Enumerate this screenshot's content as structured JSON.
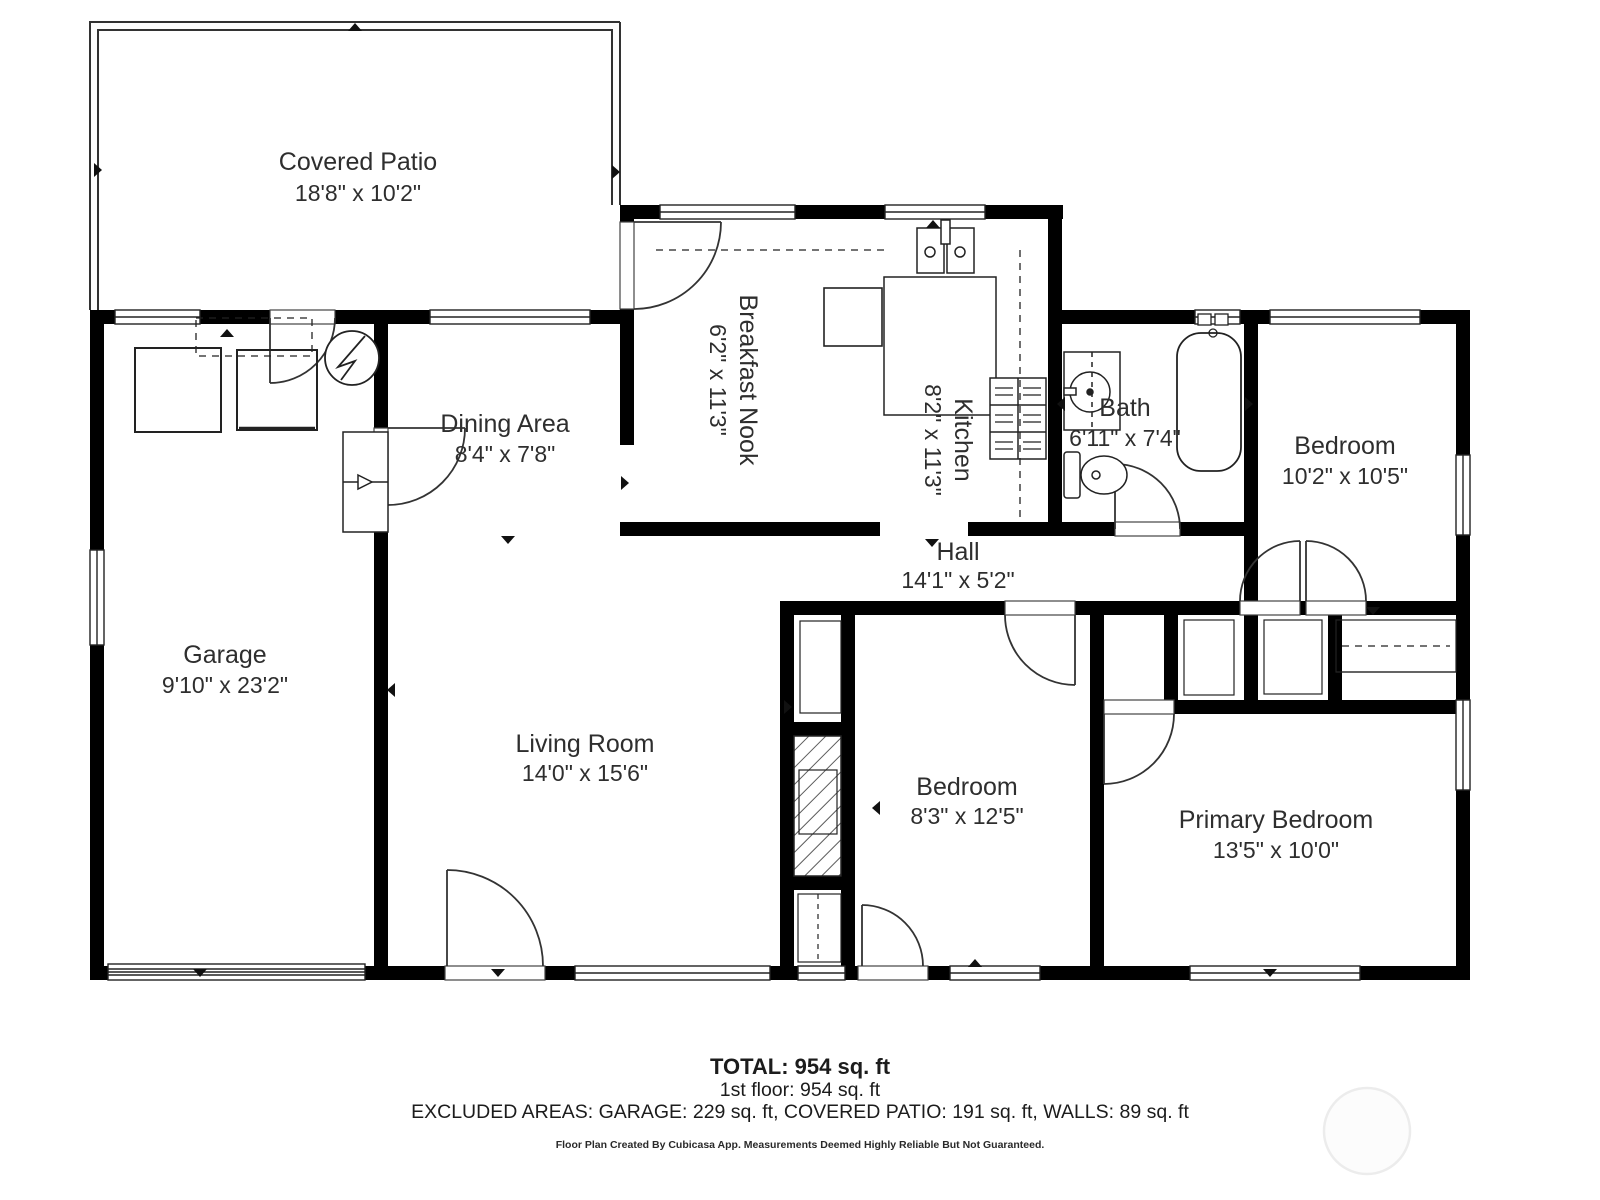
{
  "rooms": {
    "covered_patio": {
      "name": "Covered Patio",
      "dims": "18'8\" x 10'2\""
    },
    "dining": {
      "name": "Dining Area",
      "dims": "8'4\" x 7'8\""
    },
    "breakfast_nook": {
      "name": "Breakfast Nook",
      "dims": "6'2\" x 11'3\""
    },
    "kitchen": {
      "name": "Kitchen",
      "dims": "8'2\" x 11'3\""
    },
    "bath": {
      "name": "Bath",
      "dims": "6'11\" x 7'4\""
    },
    "bedroom2": {
      "name": "Bedroom",
      "dims": "10'2\" x 10'5\""
    },
    "garage": {
      "name": "Garage",
      "dims": "9'10\" x 23'2\""
    },
    "living": {
      "name": "Living Room",
      "dims": "14'0\" x 15'6\""
    },
    "hall": {
      "name": "Hall",
      "dims": "14'1\" x 5'2\""
    },
    "bedroom3": {
      "name": "Bedroom",
      "dims": "8'3\" x 12'5\""
    },
    "primary": {
      "name": "Primary Bedroom",
      "dims": "13'5\" x 10'0\""
    }
  },
  "summary": {
    "total": "TOTAL: 954 sq. ft",
    "floor1": "1st floor: 954 sq. ft",
    "excluded": "EXCLUDED AREAS: GARAGE: 229 sq. ft, COVERED PATIO: 191 sq. ft, WALLS: 89 sq. ft",
    "disclaimer": "Floor Plan Created By Cubicasa App. Measurements Deemed Highly Reliable But Not Guaranteed."
  },
  "icons": {
    "fixtures": [
      "washer-icon",
      "dryer-icon",
      "water-heater-icon",
      "stairs-icon",
      "refrigerator-icon",
      "kitchen-sink-icon",
      "stove-icon",
      "vanity-sink-icon",
      "toilet-icon",
      "bathtub-icon",
      "fireplace-icon",
      "closet-shelf",
      "watermark-circle"
    ]
  },
  "colors": {
    "wall": "#000000",
    "line": "#222222",
    "text": "#2e2e2e",
    "watermark": "#ececec"
  }
}
